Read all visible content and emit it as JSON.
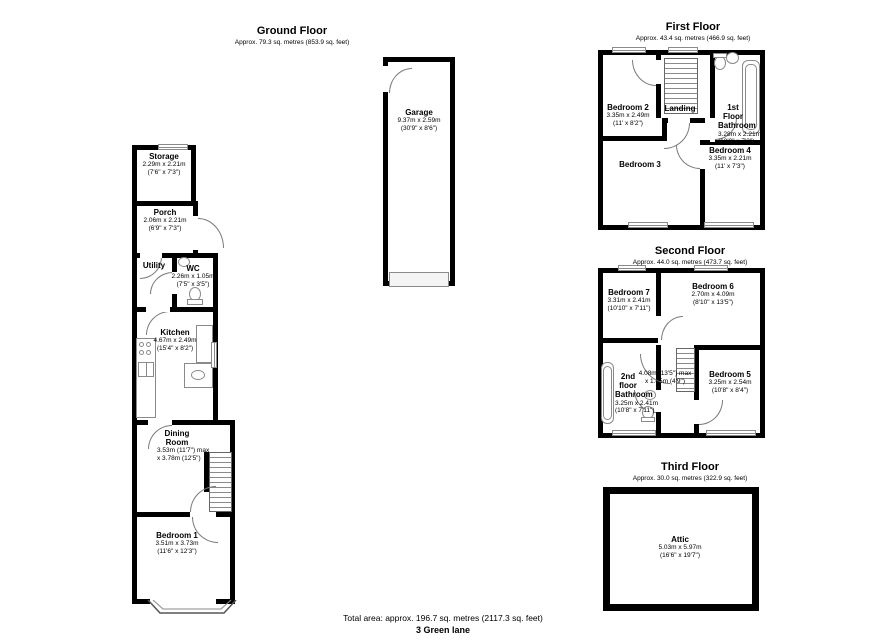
{
  "colors": {
    "wall": "#000000",
    "detail": "#8a8a8a"
  },
  "footer": {
    "total": "Total area: approx. 196.7 sq. metres (2117.3 sq. feet)",
    "address": "3 Green lane"
  },
  "ground": {
    "title": "Ground Floor",
    "subtitle": "Approx. 79.3 sq. metres (853.9 sq. feet)",
    "rooms": {
      "storage": {
        "name": "Storage",
        "metric": "2.29m x 2.21m",
        "imperial": "(7'6\" x 7'3\")"
      },
      "porch": {
        "name": "Porch",
        "metric": "2.06m x 2.21m",
        "imperial": "(6'9\" x 7'3\")"
      },
      "utility": {
        "name": "Utility"
      },
      "wc": {
        "name": "WC",
        "metric": "2.26m x 1.05m",
        "imperial": "(7'5\" x 3'5\")"
      },
      "kitchen": {
        "name": "Kitchen",
        "metric": "4.67m x 2.49m",
        "imperial": "(15'4\" x 8'2\")"
      },
      "dining": {
        "name": "Dining Room",
        "metric": "3.53m (11'7\") max",
        "imperial": "x 3.78m (12'5\")"
      },
      "bedroom1": {
        "name": "Bedroom 1",
        "metric": "3.51m x 3.73m",
        "imperial": "(11'6\" x 12'3\")"
      }
    }
  },
  "garage": {
    "rooms": {
      "garage": {
        "name": "Garage",
        "metric": "9.37m x 2.59m",
        "imperial": "(30'9\" x 8'6\")"
      }
    }
  },
  "first": {
    "title": "First Floor",
    "subtitle": "Approx. 43.4 sq. metres (466.9 sq. feet)",
    "rooms": {
      "bedroom2": {
        "name": "Bedroom 2",
        "metric": "3.35m x 2.49m",
        "imperial": "(11' x 8'2\")"
      },
      "landing": {
        "name": "Landing"
      },
      "bathroom": {
        "name": "1st Floor Bathroom",
        "metric": "3.28m x 2.21m",
        "imperial": "(10'9\" x 7'3\")"
      },
      "bedroom3": {
        "name": "Bedroom 3"
      },
      "bedroom4": {
        "name": "Bedroom 4",
        "metric": "3.35m x 2.21m",
        "imperial": "(11' x 7'3\")"
      }
    }
  },
  "second": {
    "title": "Second Floor",
    "subtitle": "Approx. 44.0 sq. metres (473.7 sq. feet)",
    "rooms": {
      "bedroom7": {
        "name": "Bedroom 7",
        "metric": "3.31m x 2.41m",
        "imperial": "(10'10\" x 7'11\")"
      },
      "bedroom6": {
        "name": "Bedroom 6",
        "metric": "2.70m x 4.09m",
        "imperial": "(8'10\" x 13'5\")"
      },
      "hall": {
        "metric": "4.08m (13'5\") max",
        "imperial": "x 1.45m (4'9\")"
      },
      "bathroom": {
        "name": "2nd floor Bathroom",
        "metric": "3.25m x 2.41m",
        "imperial": "(10'8\" x 7'11\")"
      },
      "bedroom5": {
        "name": "Bedroom 5",
        "metric": "3.25m x 2.54m",
        "imperial": "(10'8\" x 8'4\")"
      }
    }
  },
  "third": {
    "title": "Third Floor",
    "subtitle": "Approx. 30.0 sq. metres (322.9 sq. feet)",
    "rooms": {
      "attic": {
        "name": "Attic",
        "metric": "5.03m x 5.97m",
        "imperial": "(16'6\" x 19'7\")"
      }
    }
  }
}
